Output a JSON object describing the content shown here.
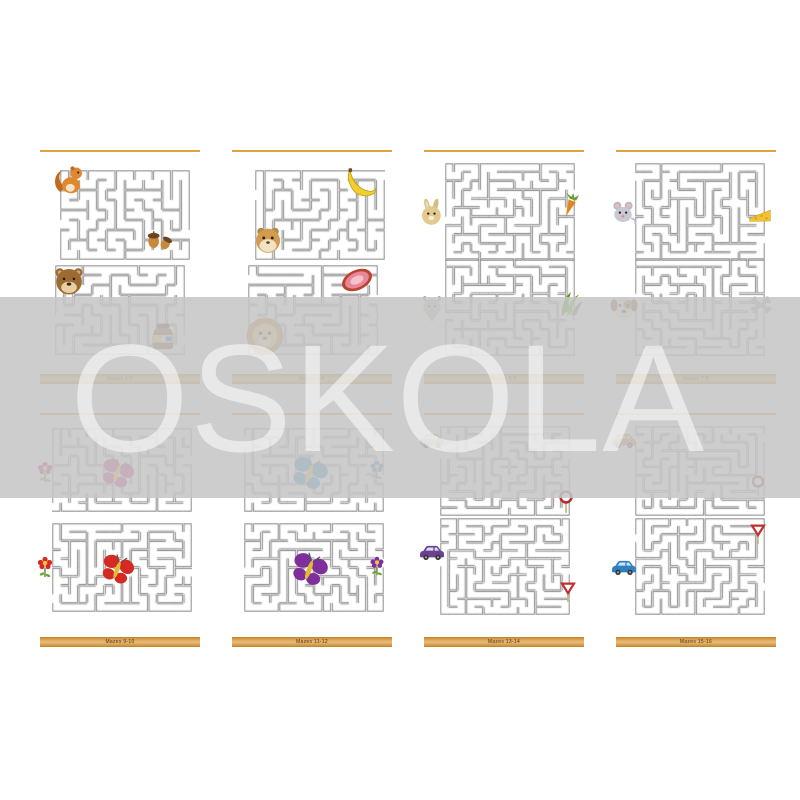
{
  "watermark": {
    "text": "OSKOLA"
  },
  "theme": {
    "accent_orange": "#e2a140",
    "footer_orange": "#dba14e",
    "band_gray": "#c6c6c6",
    "maze_wall": "#666666",
    "butterfly_magenta": "#c4207c",
    "butterfly_red": "#d42a23",
    "butterfly_blue": "#1f84c0",
    "butterfly_purple": "#7e2f9b",
    "car_green": "#74b04a",
    "car_purple": "#6f3e92",
    "car_orange": "#e08a28",
    "car_blue": "#2f7fc4"
  },
  "pages": [
    {
      "footer": "Mazes 1-2",
      "mazes": [
        {
          "x": 28,
          "y": 30,
          "w": 130,
          "h": 90,
          "cols": 14,
          "rows": 9,
          "seed": 3
        },
        {
          "x": 23,
          "y": 125,
          "w": 130,
          "h": 90,
          "cols": 14,
          "rows": 9,
          "seed": 7
        }
      ],
      "items": [
        {
          "icon": "squirrel",
          "x": 18,
          "y": 22,
          "size": 36
        },
        {
          "icon": "acorns",
          "x": 111,
          "y": 82,
          "size": 32
        },
        {
          "icon": "bear",
          "x": 20,
          "y": 124,
          "size": 34
        },
        {
          "icon": "honey-jar",
          "x": 112,
          "y": 177,
          "size": 38
        }
      ]
    },
    {
      "footer": "Mazes 3-4",
      "mazes": [
        {
          "x": 31,
          "y": 30,
          "w": 130,
          "h": 90,
          "cols": 14,
          "rows": 9,
          "seed": 11
        },
        {
          "x": 24,
          "y": 125,
          "w": 130,
          "h": 90,
          "cols": 14,
          "rows": 9,
          "seed": 13
        }
      ],
      "items": [
        {
          "icon": "banana",
          "x": 120,
          "y": 24,
          "size": 36
        },
        {
          "icon": "hamster",
          "x": 27,
          "y": 83,
          "size": 34
        },
        {
          "icon": "meat",
          "x": 114,
          "y": 121,
          "size": 38
        },
        {
          "icon": "lion",
          "x": 19,
          "y": 174,
          "size": 44
        }
      ]
    },
    {
      "footer": "Mazes 5-6",
      "mazes": [
        {
          "x": 29,
          "y": 23,
          "w": 130,
          "h": 98,
          "cols": 15,
          "rows": 11,
          "seed": 17
        },
        {
          "x": 29,
          "y": 118,
          "w": 130,
          "h": 98,
          "cols": 15,
          "rows": 11,
          "seed": 19
        }
      ],
      "items": [
        {
          "icon": "rabbit",
          "x": 1,
          "y": 58,
          "size": 30
        },
        {
          "icon": "carrot",
          "x": 141,
          "y": 51,
          "size": 28
        },
        {
          "icon": "goat",
          "x": 0,
          "y": 153,
          "size": 32
        },
        {
          "icon": "grass",
          "x": 139,
          "y": 148,
          "size": 32
        }
      ]
    },
    {
      "footer": "Mazes 7-8",
      "mazes": [
        {
          "x": 27,
          "y": 23,
          "w": 130,
          "h": 98,
          "cols": 15,
          "rows": 11,
          "seed": 23
        },
        {
          "x": 27,
          "y": 118,
          "w": 130,
          "h": 98,
          "cols": 15,
          "rows": 11,
          "seed": 29
        }
      ],
      "items": [
        {
          "icon": "mouse",
          "x": 0,
          "y": 57,
          "size": 30
        },
        {
          "icon": "cheese",
          "x": 139,
          "y": 61,
          "size": 26
        },
        {
          "icon": "dog",
          "x": 0,
          "y": 152,
          "size": 32
        },
        {
          "icon": "bones",
          "x": 138,
          "y": 150,
          "size": 30
        }
      ]
    },
    {
      "footer": "Mazes 9-10",
      "mazes": [
        {
          "x": 20,
          "y": 25,
          "w": 140,
          "h": 84,
          "cols": 16,
          "rows": 9,
          "seed": 31
        },
        {
          "x": 20,
          "y": 120,
          "w": 140,
          "h": 89,
          "cols": 16,
          "rows": 10,
          "seed": 37
        }
      ],
      "items": [
        {
          "icon": "butterfly",
          "color": "#c4207c",
          "x": 66,
          "y": 52,
          "size": 38
        },
        {
          "icon": "flower",
          "color": "#c4207c",
          "x": 1,
          "y": 57,
          "size": 24
        },
        {
          "icon": "butterfly",
          "color": "#d42a23",
          "x": 66,
          "y": 148,
          "size": 38
        },
        {
          "icon": "flower",
          "color": "#d42a23",
          "x": 1,
          "y": 152,
          "size": 24
        }
      ]
    },
    {
      "footer": "Mazes 11-12",
      "mazes": [
        {
          "x": 20,
          "y": 25,
          "w": 140,
          "h": 84,
          "cols": 16,
          "rows": 9,
          "seed": 41
        },
        {
          "x": 20,
          "y": 120,
          "w": 140,
          "h": 89,
          "cols": 16,
          "rows": 10,
          "seed": 43
        }
      ],
      "items": [
        {
          "icon": "butterfly",
          "color": "#1f84c0",
          "x": 64,
          "y": 50,
          "size": 42
        },
        {
          "icon": "flower",
          "color": "#1f84c0",
          "x": 142,
          "y": 56,
          "size": 22
        },
        {
          "icon": "butterfly",
          "color": "#7e2f9b",
          "x": 64,
          "y": 146,
          "size": 42
        },
        {
          "icon": "flower",
          "color": "#7e2f9b",
          "x": 142,
          "y": 152,
          "size": 22
        }
      ]
    },
    {
      "footer": "Mazes 13-14",
      "mazes": [
        {
          "x": 24,
          "y": 23,
          "w": 130,
          "h": 90,
          "cols": 15,
          "rows": 11,
          "seed": 47
        },
        {
          "x": 24,
          "y": 115,
          "w": 130,
          "h": 97,
          "cols": 15,
          "rows": 12,
          "seed": 53
        }
      ],
      "items": [
        {
          "icon": "car",
          "color": "#74b04a",
          "x": 0,
          "y": 21,
          "size": 32
        },
        {
          "icon": "sign-round",
          "x": 137,
          "y": 87,
          "size": 26
        },
        {
          "icon": "car",
          "color": "#6f3e92",
          "x": 0,
          "y": 133,
          "size": 32
        },
        {
          "icon": "sign-triangle",
          "x": 140,
          "y": 178,
          "size": 24
        }
      ]
    },
    {
      "footer": "Mazes 15-16",
      "mazes": [
        {
          "x": 27,
          "y": 23,
          "w": 130,
          "h": 90,
          "cols": 15,
          "rows": 11,
          "seed": 59
        },
        {
          "x": 27,
          "y": 115,
          "w": 130,
          "h": 97,
          "cols": 15,
          "rows": 12,
          "seed": 61
        }
      ],
      "items": [
        {
          "icon": "car",
          "color": "#e08a28",
          "x": 0,
          "y": 21,
          "size": 32
        },
        {
          "icon": "sign-round",
          "x": 138,
          "y": 72,
          "size": 24
        },
        {
          "icon": "car",
          "color": "#2f7fc4",
          "x": 0,
          "y": 148,
          "size": 32
        },
        {
          "icon": "sign-triangle",
          "x": 138,
          "y": 120,
          "size": 24
        }
      ]
    }
  ]
}
